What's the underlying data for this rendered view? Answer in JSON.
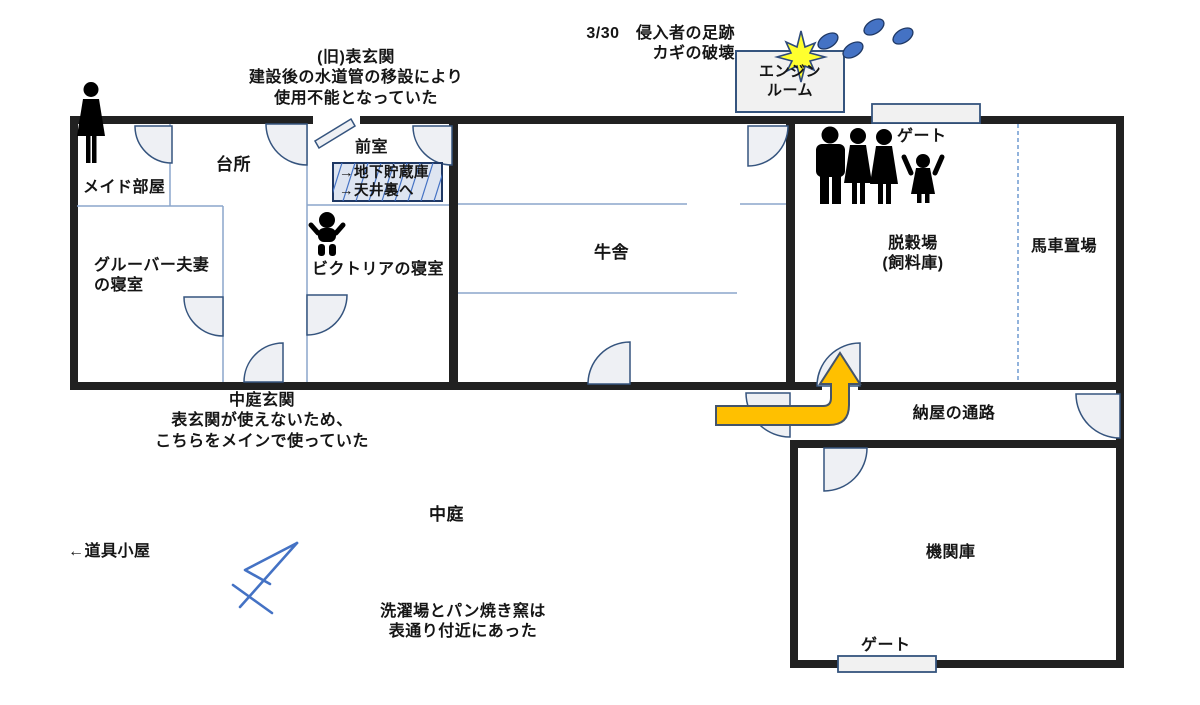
{
  "diagram": {
    "rooms": {
      "maid_room": "メイド部屋",
      "kitchen": "台所",
      "front_room": "前室",
      "gruber_bedroom": "グルーバー夫妻\nの寝室",
      "victoria_bedroom": "ビクトリアの寝室",
      "cowshed": "牛舎",
      "threshing_floor": "脱穀場\n(飼料庫)",
      "carriage_shed": "馬車置場",
      "barn_passage": "納屋の通路",
      "engine_shed": "機関庫",
      "engine_room": "エンジン\nルーム",
      "courtyard": "中庭"
    },
    "labels": {
      "gate_top": "ゲート",
      "gate_bottom": "ゲート",
      "tool_shed": "←道具小屋",
      "storage_sign": "→地下貯蔵庫\n→天井裏へ"
    },
    "annotations": {
      "old_front_entrance": "(旧)表玄関\n建設後の水道管の移設により\n使用不能となっていた",
      "intruder_note": "3/30　侵入者の足跡\nカギの破壊",
      "courtyard_entrance": "中庭玄関\n表玄関が使えないため、\nこちらをメインで使っていた",
      "laundry_note": "洗濯場とパン焼き窯は\n表通り付近にあった"
    },
    "icons": {
      "maid": "woman-silhouette-icon",
      "baby": "baby-icon",
      "family": "family-silhouettes-icon",
      "footprints": "footprints-icon",
      "break_star": "impact-star-icon",
      "entry_arrow": "entry-route-arrow",
      "north_sketch": "hand-drawn-compass-arrow"
    },
    "colors": {
      "wall": "#212121",
      "partition": "#8ba6cc",
      "door_fill": "#eef0f4",
      "door_stroke": "#35547e",
      "accent_blue": "#4472c4",
      "footprint_fill": "#4472c4",
      "arrow_fill": "#ffc000",
      "star_fill": "#ffff2e"
    }
  }
}
